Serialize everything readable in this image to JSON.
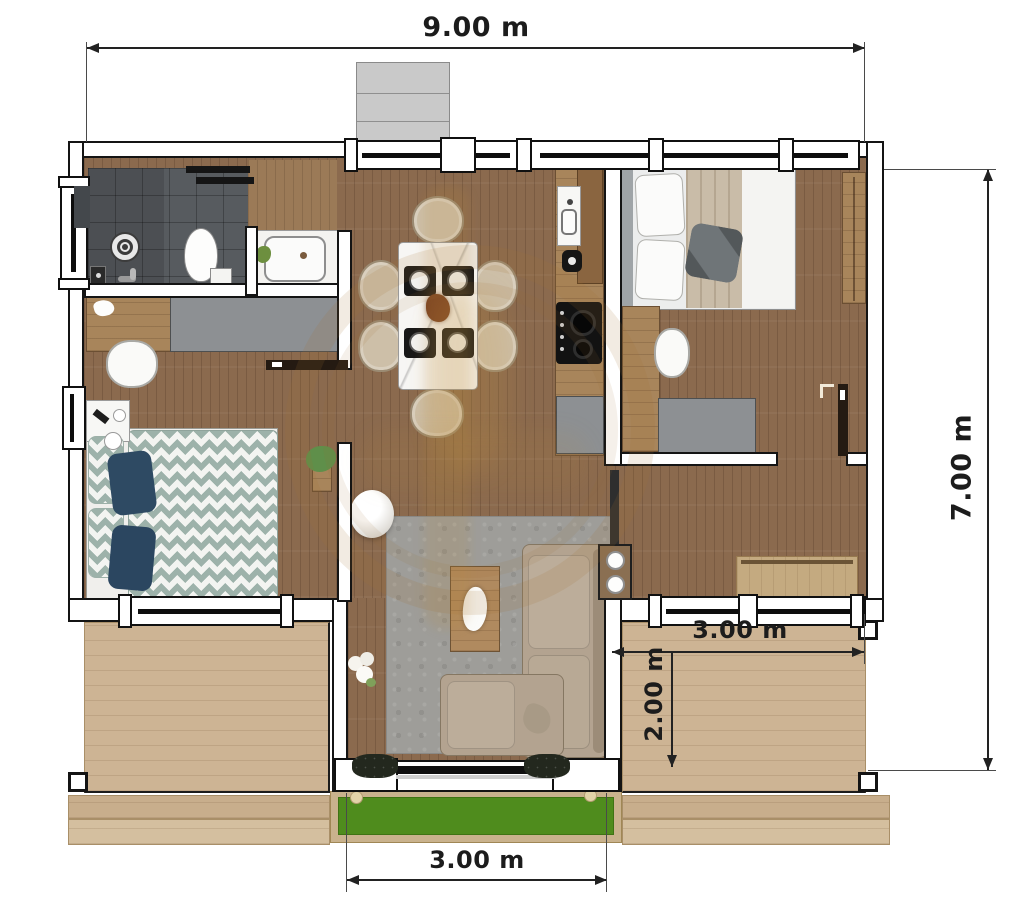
{
  "dimensions": {
    "overall_width": "9.00 m",
    "overall_depth": "7.00 m",
    "right_terrace_width": "3.00 m",
    "right_terrace_depth": "2.00 m",
    "entrance_width": "3.00 m"
  },
  "palette": {
    "background": "#ffffff",
    "wall_outline": "#141414",
    "interior_floor_wood": "#8b6a4e",
    "deck_wood": "#cdb494",
    "lawn_green": "#4f8c1d",
    "bathroom_tile": "#575b5f",
    "cabinet_gray": "#8d9093",
    "counter_wood": "#a8855b",
    "sofa_beige": "#b3a390",
    "rug_gray": "#9e9d99",
    "duvet_teal": "#9db2aa",
    "pillow_navy": "#2e4a63",
    "dimension_ink": "#1c1c1c",
    "watermark_amber": "#a07032"
  },
  "furniture": {
    "bathroom": [
      "shower-drain",
      "toilet",
      "vanity-sink",
      "sliding-door"
    ],
    "bedroom_left": [
      "desk",
      "wardrobe",
      "chair",
      "nightstand",
      "double-bed-chevron",
      "plant"
    ],
    "dining": [
      "marble-table",
      "six-chairs",
      "place-settings",
      "centerpiece"
    ],
    "kitchen": [
      "sink",
      "cooktop",
      "cabinet",
      "counter"
    ],
    "bedroom_right": [
      "double-bed",
      "wardrobe",
      "desk",
      "chair",
      "bench"
    ],
    "living": [
      "corner-sofa",
      "rug",
      "coffee-table",
      "pouf",
      "side-table",
      "tv",
      "sliding-door"
    ],
    "outdoor": [
      "deck-left",
      "deck-right",
      "lawn",
      "entry-steps"
    ]
  }
}
